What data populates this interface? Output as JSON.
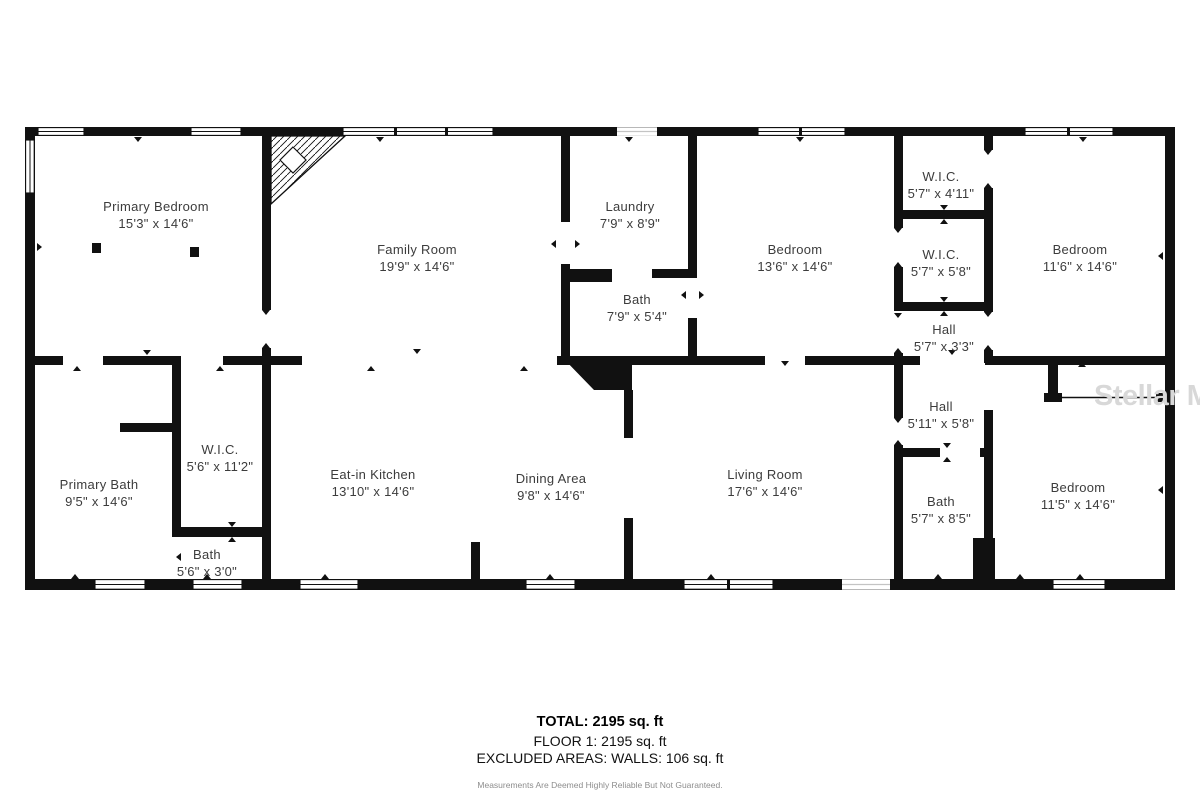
{
  "colors": {
    "wall": "#111111",
    "label_text": "#3c3c3c",
    "watermark": "#d8d8d8",
    "disclaimer": "#8d8d8d"
  },
  "watermark": {
    "text": "Stellar MLS"
  },
  "rooms": [
    {
      "name": "Primary Bedroom",
      "dims": "15'3\" x 14'6\"",
      "cx": 156,
      "cy": 215
    },
    {
      "name": "Family Room",
      "dims": "19'9\" x 14'6\"",
      "cx": 417,
      "cy": 258
    },
    {
      "name": "Laundry",
      "dims": "7'9\" x 8'9\"",
      "cx": 630,
      "cy": 215
    },
    {
      "name": "Bath",
      "dims": "7'9\" x 5'4\"",
      "cx": 637,
      "cy": 308
    },
    {
      "name": "Bedroom",
      "dims": "13'6\" x 14'6\"",
      "cx": 795,
      "cy": 258
    },
    {
      "name": "W.I.C.",
      "dims": "5'7\" x 4'11\"",
      "cx": 941,
      "cy": 185
    },
    {
      "name": "W.I.C.",
      "dims": "5'7\" x 5'8\"",
      "cx": 941,
      "cy": 263
    },
    {
      "name": "Hall",
      "dims": "5'7\" x 3'3\"",
      "cx": 944,
      "cy": 338
    },
    {
      "name": "Bedroom",
      "dims": "11'6\" x 14'6\"",
      "cx": 1080,
      "cy": 258
    },
    {
      "name": "Primary Bath",
      "dims": "9'5\" x 14'6\"",
      "cx": 99,
      "cy": 493
    },
    {
      "name": "W.I.C.",
      "dims": "5'6\" x 11'2\"",
      "cx": 220,
      "cy": 458
    },
    {
      "name": "Bath",
      "dims": "5'6\" x 3'0\"",
      "cx": 207,
      "cy": 563
    },
    {
      "name": "Eat-in Kitchen",
      "dims": "13'10\" x 14'6\"",
      "cx": 373,
      "cy": 483
    },
    {
      "name": "Dining Area",
      "dims": "9'8\" x 14'6\"",
      "cx": 551,
      "cy": 487
    },
    {
      "name": "Living Room",
      "dims": "17'6\" x 14'6\"",
      "cx": 765,
      "cy": 483
    },
    {
      "name": "Hall",
      "dims": "5'11\" x 5'8\"",
      "cx": 941,
      "cy": 415
    },
    {
      "name": "Bath",
      "dims": "5'7\" x 8'5\"",
      "cx": 941,
      "cy": 510
    },
    {
      "name": "Bedroom",
      "dims": "11'5\" x 14'6\"",
      "cx": 1078,
      "cy": 496
    }
  ],
  "footer": {
    "total": "TOTAL: 2195 sq. ft",
    "floor": "FLOOR 1: 2195 sq. ft",
    "excluded": "EXCLUDED AREAS: WALLS: 106 sq. ft",
    "disclaimer": "Measurements Are Deemed Highly Reliable But Not Guaranteed."
  }
}
